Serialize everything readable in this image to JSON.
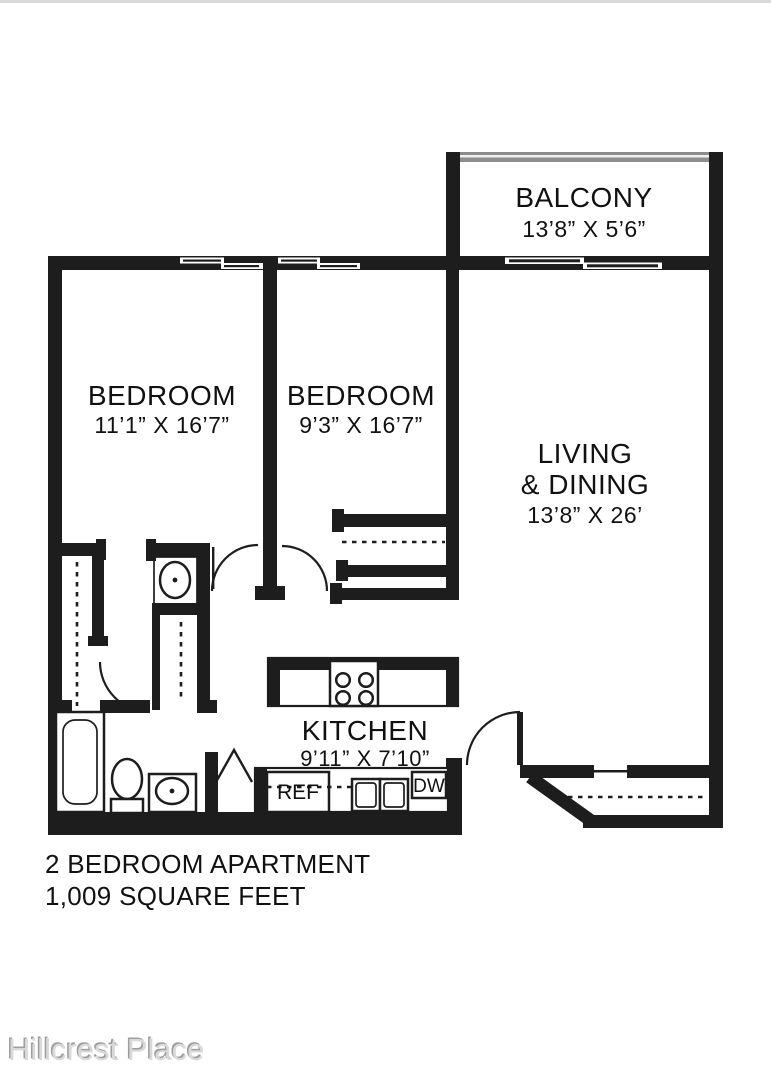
{
  "floor_plan": {
    "rooms": {
      "balcony": {
        "name": "BALCONY",
        "dimensions": "13’8” X 5’6”"
      },
      "bedroom1": {
        "name": "BEDROOM",
        "dimensions": "11’1” X 16’7”"
      },
      "bedroom2": {
        "name": "BEDROOM",
        "dimensions": "9’3” X 16’7”"
      },
      "living_dining": {
        "line1": "LIVING",
        "line2": "& DINING",
        "dimensions": "13’8” X 26’"
      },
      "kitchen": {
        "name": "KITCHEN",
        "dimensions": "9’11” X 7’10”"
      }
    },
    "appliances": {
      "refrigerator": "REF",
      "dishwasher": "DW"
    },
    "summary": {
      "line1": "2 BEDROOM APARTMENT",
      "line2": "1,009 SQUARE FEET"
    },
    "watermark": "Hillcrest Place",
    "colors": {
      "wall": "#1d1d1d",
      "background": "#ffffff",
      "railing": "#8d8d8d",
      "watermark": "#d9d9d9"
    }
  }
}
